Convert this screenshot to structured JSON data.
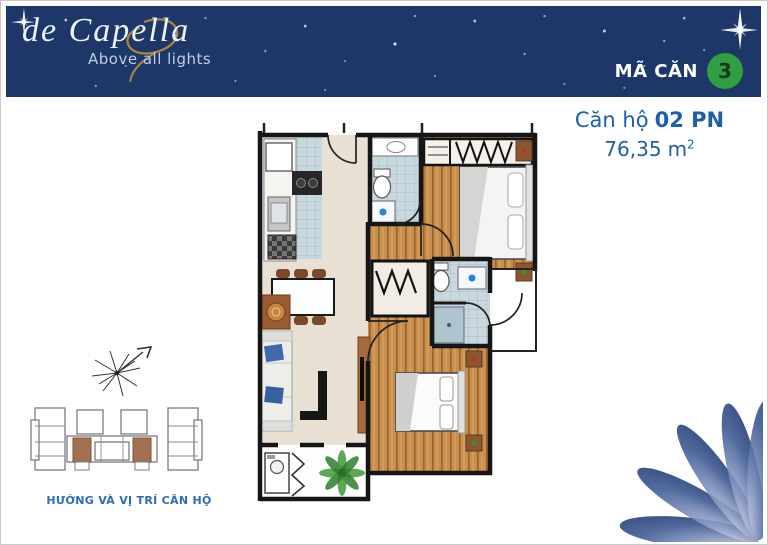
{
  "header": {
    "logo_text": "de Capella",
    "logo_tagline": "Above all lights",
    "unit_code_label": "MÃ CĂN",
    "unit_code_value": "3"
  },
  "unit_info": {
    "type_prefix": "Căn hộ",
    "type_value": "02 PN",
    "area_value": "76,35",
    "area_unit": "m",
    "area_exponent": "2"
  },
  "locator": {
    "caption": "HƯỚNG VÀ VỊ TRÍ CĂN HỘ"
  },
  "icons": {
    "sparkle_star": "✦",
    "compass_rose": "✳",
    "lotus_petals": "❁",
    "plant": "❀"
  },
  "colors": {
    "header_bg": "#1c3768",
    "accent_green": "#2f9f42",
    "badge_text": "#193a22",
    "title_blue": "#1d5fa8",
    "caption_blue": "#2b6cbb",
    "gold": "#b9913f",
    "tagline": "#c2cde2",
    "wall": "#161616",
    "floor_beige": "#e8e0d3",
    "wood": "#c78e4d",
    "tile": "#c9d8de",
    "highlight_brown": "#a3714f",
    "petal_blue": "#24407e"
  }
}
